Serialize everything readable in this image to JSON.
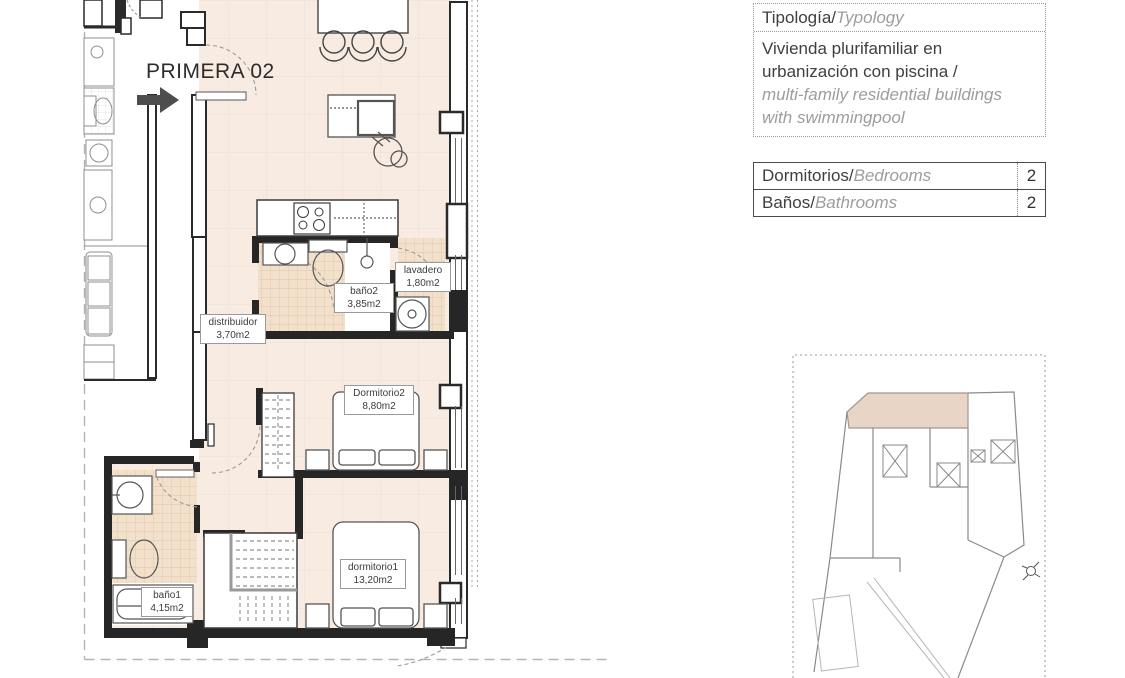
{
  "plan": {
    "title": "PRIMERA 02",
    "rooms": [
      {
        "name": "distribuidor",
        "area": "3,70m2"
      },
      {
        "name": "baño2",
        "area": "3,85m2"
      },
      {
        "name": "lavadero",
        "area": "1,80m2"
      },
      {
        "name": "Dormitorio2",
        "area": "8,80m2"
      },
      {
        "name": "baño1",
        "area": "4,15m2"
      },
      {
        "name": "dormitorio1",
        "area": "13,20m2"
      }
    ]
  },
  "info_panel": {
    "typology_label_es": "Tipología/",
    "typology_label_en": "Typology",
    "description_es_line1": "Vivienda plurifamiliar en",
    "description_es_line2": "urbanización con piscina  /",
    "description_en_line1": "multi-family residential buildings",
    "description_en_line2": "with swimmingpool",
    "specs": [
      {
        "label_es": "Dormitorios/",
        "label_en": "Bedrooms",
        "value": "2"
      },
      {
        "label_es": "Baños/",
        "label_en": "Bathrooms",
        "value": "2"
      }
    ]
  },
  "colors": {
    "floor": "#f8ebe2",
    "tile": "#f2e0cb",
    "wall": "#262626",
    "arrow": "#4d4d4d",
    "unit_highlight": "#e9d5c6"
  }
}
